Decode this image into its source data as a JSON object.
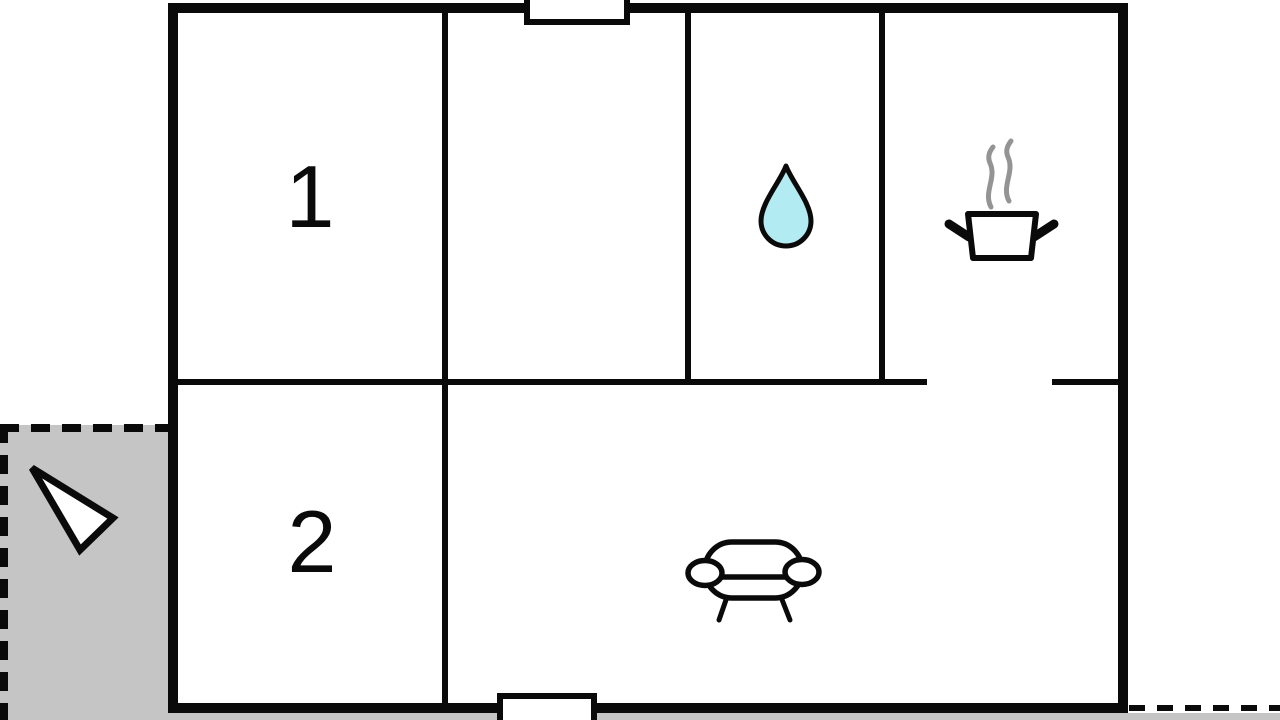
{
  "floor_plan": {
    "rooms": [
      {
        "label": "1"
      },
      {
        "label": "2"
      }
    ],
    "icons": [
      {
        "name": "water-drop-icon",
        "meaning": "bathroom"
      },
      {
        "name": "cooking-pot-icon",
        "meaning": "kitchen"
      },
      {
        "name": "steam-icon",
        "meaning": "steam above pot"
      },
      {
        "name": "sofa-icon",
        "meaning": "living room"
      },
      {
        "name": "direction-arrow-icon",
        "meaning": "entrance / orientation arrow on terrace"
      },
      {
        "name": "door-opening-top",
        "meaning": "door or window opening"
      },
      {
        "name": "door-opening-bottom",
        "meaning": "door or window opening"
      }
    ],
    "colors": {
      "wall": "#0a0a0a",
      "floor": "#ffffff",
      "terrace": "#c5c5c5",
      "water_drop": "#b2ebf2",
      "steam": "#949494",
      "door_fill": "#ffffff",
      "arrow_fill": "#ffffff"
    }
  }
}
